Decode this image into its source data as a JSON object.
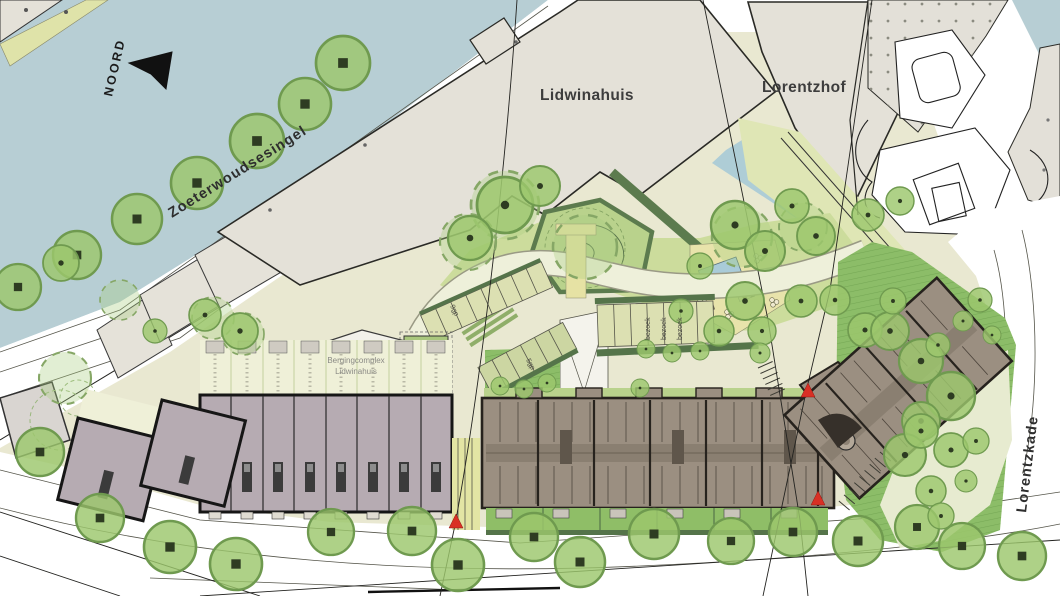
{
  "map": {
    "north_label": "NOORD",
    "streets": {
      "top": "Zoeterwoudsesingel",
      "right": "Lorentzkade"
    },
    "buildings": {
      "lidwinahuis": "Lidwinahuis",
      "lorentzhof": "Lorentzhof",
      "berging_line1": "Bergingcomplex",
      "berging_line2": "Lidwinahuis"
    },
    "parking": {
      "visitor": "bezoek",
      "row_a": "9gp",
      "row_b": "5gp"
    },
    "palette": {
      "water": "#b7ced4",
      "site": "#e9e8d1",
      "existing_building": "#e4e1d8",
      "rowhouses": "#b6abb2",
      "apartment_building": "#9b8f81",
      "tree": "#9ac46a",
      "lawn": "#8cbd68",
      "hedge": "#5c7b4e",
      "entrance_marker": "#d93025"
    }
  }
}
